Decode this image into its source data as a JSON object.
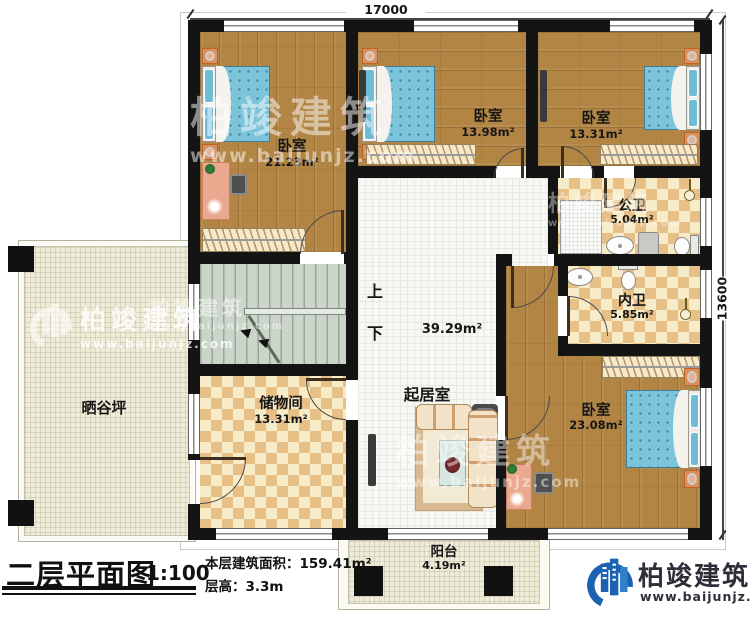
{
  "meta": {
    "title": "二层平面图",
    "scale": "1:100",
    "area_line": "本层建筑面积：159.41m²",
    "height_line": "层高：3.3m"
  },
  "dimensions": {
    "top": "17000",
    "right": "13600"
  },
  "rooms": {
    "bedroom_tl": {
      "name": "卧室",
      "area": "21.23m²"
    },
    "bedroom_tm": {
      "name": "卧室",
      "area": "13.98m²"
    },
    "bedroom_tr": {
      "name": "卧室",
      "area": "13.31m²"
    },
    "bath_public": {
      "name": "公卫",
      "area": "5.04m²"
    },
    "bath_private": {
      "name": "内卫",
      "area": "5.85m²"
    },
    "living": {
      "name": "起居室",
      "area": "39.29m²"
    },
    "storage": {
      "name": "储物间",
      "area": "13.31m²"
    },
    "bedroom_br": {
      "name": "卧室",
      "area": "23.08m²"
    },
    "balcony": {
      "name": "阳台",
      "area": "4.19m²"
    },
    "drying_yard": {
      "name": "晒谷坪"
    },
    "stair_up": "上",
    "stair_down": "下"
  },
  "brand": {
    "name": "柏竣建筑",
    "website": "www.baijunjz.com"
  },
  "watermark": {
    "name": "柏竣建筑",
    "website": "www.baijunjz.com"
  },
  "colors": {
    "wall": "#141414",
    "accent_blue": "#1b63b2",
    "bed_blue": "#7cc4da",
    "wood": "#b28545"
  }
}
